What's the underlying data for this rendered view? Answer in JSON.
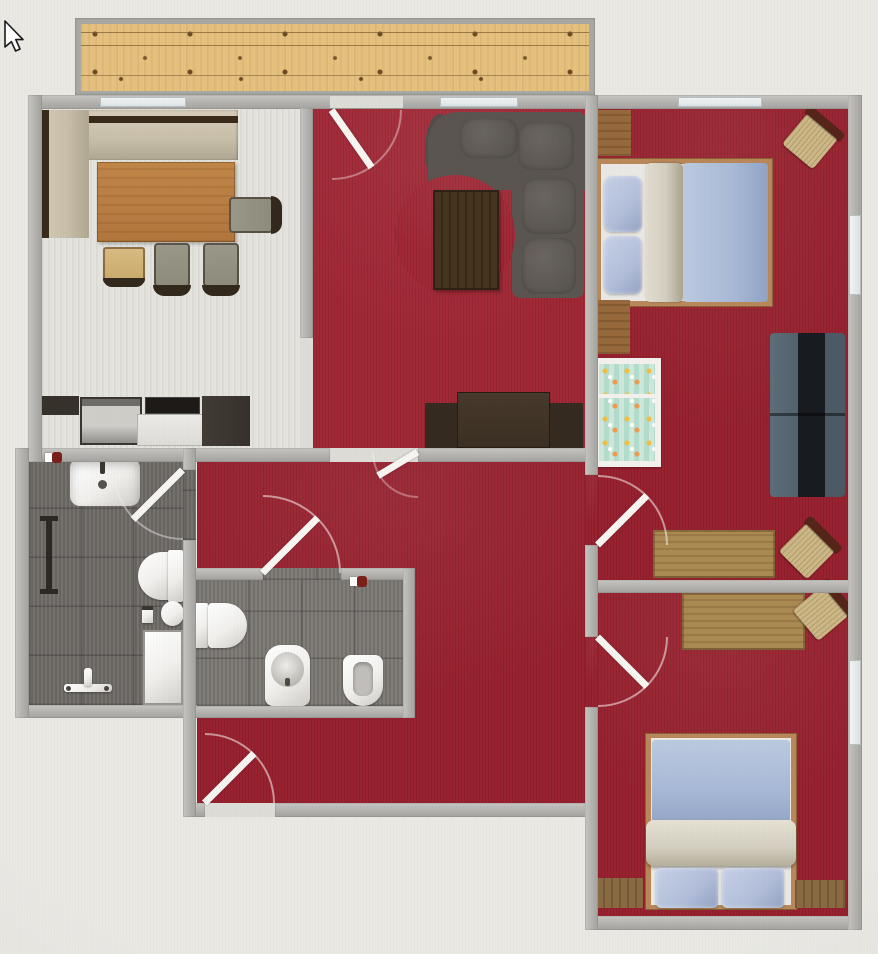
{
  "app": {
    "view": "2d-floor-plan",
    "visible_text": []
  },
  "cursor": {
    "shape": "arrow-pointer"
  },
  "palette": {
    "background": "#e9e8e3",
    "wall_a": "#c6c5c1",
    "wall_b": "#a3a29e",
    "carpet": "#9a2230",
    "carpet_living": "#a32836",
    "kitchen_floor": "#e4e3de",
    "tile": "#6e6a66",
    "tile_wc": "#7a7672",
    "deck": "#e5c07e",
    "deck_line": "#7e5c32",
    "door_white": "#f6f5f1",
    "window_glass": "#e7ebec",
    "bench": "#c7bea9",
    "bench_frame": "#3a2a1a",
    "table_wood": "#b1763c",
    "chair_seat": "#8d8b7b",
    "chair_frame": "#33281c",
    "counter_dark": "#36312b",
    "counter_white": "#dddbd6",
    "sofa_gray": "#5a5550",
    "sofa_gray_light": "#6a6560",
    "coffee_table": "#46341e",
    "tv_board": "#3b2f23",
    "bed_frame": "#b8885a",
    "mattress": "#eae8e4",
    "pillow_blue": "#b2bed9",
    "duvet_blue": "#a8b9d7",
    "blanket_beige": "#d3cebf",
    "crib_teal": "#cde7da",
    "navy_sofa": "#4b5a64",
    "navy_dark": "#181b1f",
    "desk_wood": "#ab8952",
    "rchair_seat": "#ccb787",
    "rchair_frame": "#56251a",
    "fixture_white": "#f0efec",
    "wood_floor": "#8a6a42",
    "accent_red": "#7a2018"
  },
  "scene": {
    "type": "apartment-floor-plan-top-view",
    "rooms": [
      {
        "id": "balcony",
        "floor": "wood-deck"
      },
      {
        "id": "kitchen-dining",
        "floor": "light-laminate",
        "furniture": [
          "corner-bench",
          "dining-table",
          "dining-chair",
          "dining-chair",
          "dining-chair",
          "wooden-chair",
          "kitchen-counter",
          "cooktop",
          "oven",
          "tall-cabinet"
        ]
      },
      {
        "id": "living-room",
        "floor": "red-carpet",
        "furniture": [
          "curved-sectional-sofa",
          "coffee-table",
          "tv-sideboard"
        ]
      },
      {
        "id": "hallway",
        "floor": "red-carpet",
        "furniture": []
      },
      {
        "id": "bathroom",
        "floor": "dark-gray-tile",
        "furniture": [
          "washbasin",
          "towel-rail",
          "toilet",
          "toilet-paper-holder",
          "stool",
          "shower-fixture",
          "shower-tray"
        ]
      },
      {
        "id": "wc",
        "floor": "gray-tile",
        "furniture": [
          "toilet",
          "bidet",
          "urinal"
        ]
      },
      {
        "id": "bedroom-1",
        "floor": "red-carpet",
        "furniture": [
          "double-bed",
          "dresser",
          "dresser",
          "crib",
          "wall-sofa",
          "desk",
          "desk-chair",
          "corner-chair"
        ]
      },
      {
        "id": "bedroom-2",
        "floor": "red-carpet",
        "furniture": [
          "single-bed",
          "desk",
          "desk-chair",
          "wood-floor-strip",
          "wood-floor-strip"
        ]
      }
    ],
    "doors": [
      "balcony-door",
      "living-to-hallway-door",
      "bathroom-door",
      "wc-door",
      "entry-door",
      "bedroom-1-door",
      "bedroom-2-door"
    ],
    "windows": 6
  }
}
